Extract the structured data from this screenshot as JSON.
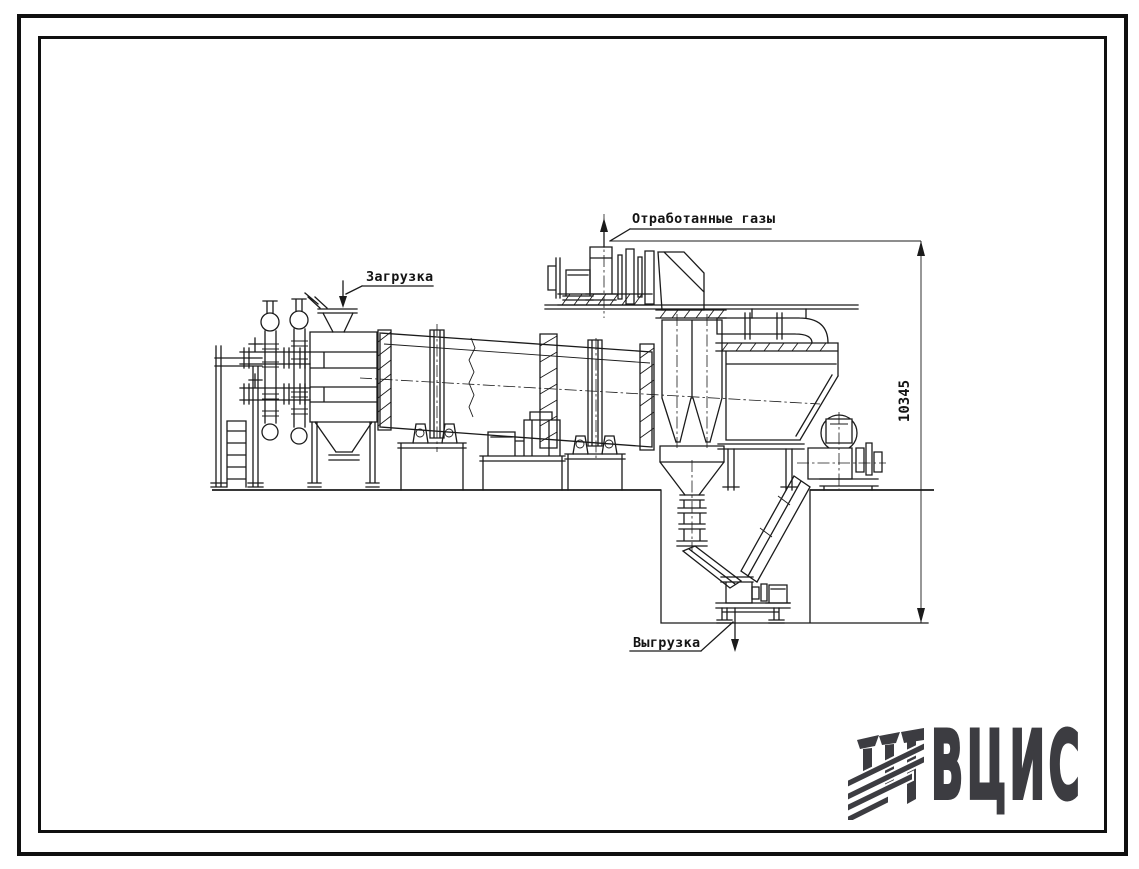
{
  "page": {
    "background": "#ffffff",
    "frame_color": "#101010"
  },
  "drawing": {
    "line_color": "#1b1b1b",
    "labels": {
      "exhaust_gases": "Отработанные газы",
      "loading": "Загрузка",
      "unloading": "Выгрузка"
    },
    "dimensions": {
      "overall_height": "10345"
    }
  },
  "branding": {
    "logo_text": "ВЦИС",
    "logo_color": "#3c3c41"
  }
}
